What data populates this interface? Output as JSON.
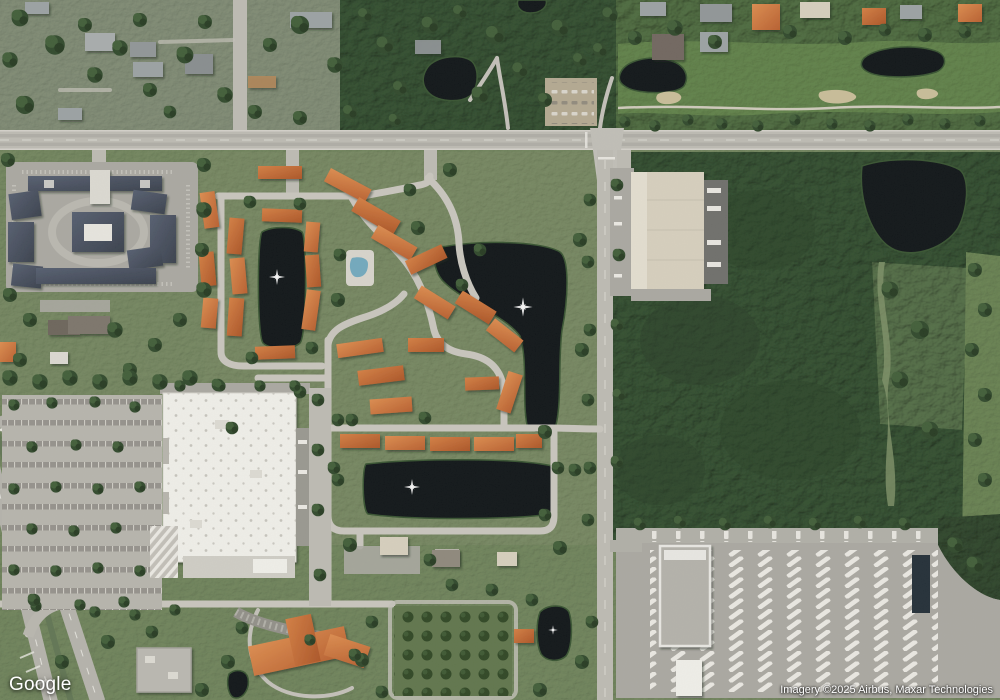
{
  "overlay": {
    "logo": "Google",
    "attribution": "Imagery ©2025 Airbus, Maxar Technologies"
  },
  "map": {
    "view_type": "satellite-imagery",
    "zoom_context": "suburban commercial and residential area with golf course, condo complex with orange roofs, big-box retail store, warehouse, truck depot and ponds",
    "colors": {
      "water": "#0a0f12",
      "woods": "#2e4a2b",
      "grass": "#71855c",
      "fairway": "#5e8046",
      "road": "#bcbab2",
      "asphalt": "#a9a7a0",
      "sand": "#c8bc97",
      "roof-orange": "#bf5f2c",
      "roof-white": "#f1f0ea",
      "roof-slate": "#444d5e",
      "roof-tan": "#d7cfbd"
    }
  }
}
